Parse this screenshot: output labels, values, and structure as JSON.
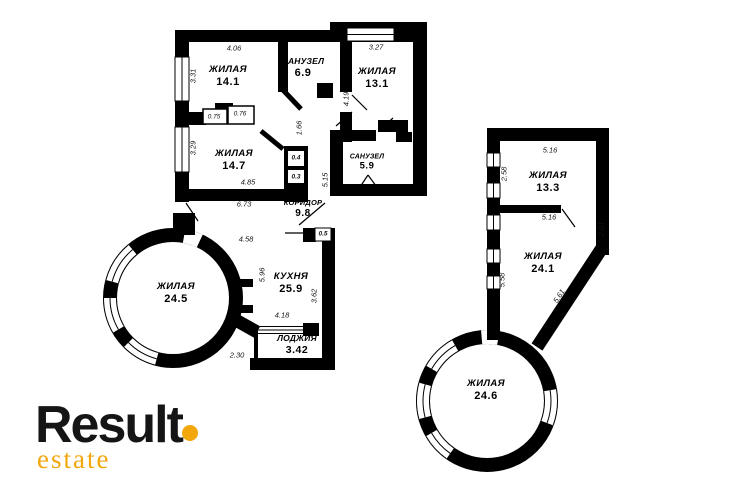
{
  "brand": {
    "name": "Result",
    "tagline": "estate",
    "accent_color": "#F2A70D",
    "text_color": "#151515"
  },
  "rooms": [
    {
      "id": "living-14-1",
      "name": "ЖИЛАЯ",
      "area": "14.1"
    },
    {
      "id": "bath-6-9",
      "name": "САНУЗЕЛ",
      "area": "6.9"
    },
    {
      "id": "living-13-1",
      "name": "ЖИЛАЯ",
      "area": "13.1"
    },
    {
      "id": "living-14-7",
      "name": "ЖИЛАЯ",
      "area": "14.7"
    },
    {
      "id": "bath-5-9",
      "name": "САНУЗЕЛ",
      "area": "5.9"
    },
    {
      "id": "corridor-9-8",
      "name": "КОРИДОР",
      "area": "9.8"
    },
    {
      "id": "living-24-5",
      "name": "ЖИЛАЯ",
      "area": "24.5"
    },
    {
      "id": "kitchen-25-9",
      "name": "КУХНЯ",
      "area": "25.9"
    },
    {
      "id": "loggia-3-42",
      "name": "ЛОДЖИЯ",
      "area": "3.42"
    },
    {
      "id": "living-13-3",
      "name": "ЖИЛАЯ",
      "area": "13.3"
    },
    {
      "id": "living-24-1",
      "name": "ЖИЛАЯ",
      "area": "24.1"
    },
    {
      "id": "living-24-6",
      "name": "ЖИЛАЯ",
      "area": "24.6"
    }
  ],
  "dims": [
    {
      "value": "4.06"
    },
    {
      "value": "3.31"
    },
    {
      "value": "3.27"
    },
    {
      "value": "4.19"
    },
    {
      "value": "0.75"
    },
    {
      "value": "0.76"
    },
    {
      "value": "1.66"
    },
    {
      "value": "3.29"
    },
    {
      "value": "0.4"
    },
    {
      "value": "0.3"
    },
    {
      "value": "4.85"
    },
    {
      "value": "5.15"
    },
    {
      "value": "6.73"
    },
    {
      "value": "0.5"
    },
    {
      "value": "4.58"
    },
    {
      "value": "5.96"
    },
    {
      "value": "4.18"
    },
    {
      "value": "3.62"
    },
    {
      "value": "2.30"
    },
    {
      "value": "5.16"
    },
    {
      "value": "2.58"
    },
    {
      "value": "5.16"
    },
    {
      "value": "2.01"
    },
    {
      "value": "5.58"
    },
    {
      "value": "5.61"
    }
  ]
}
